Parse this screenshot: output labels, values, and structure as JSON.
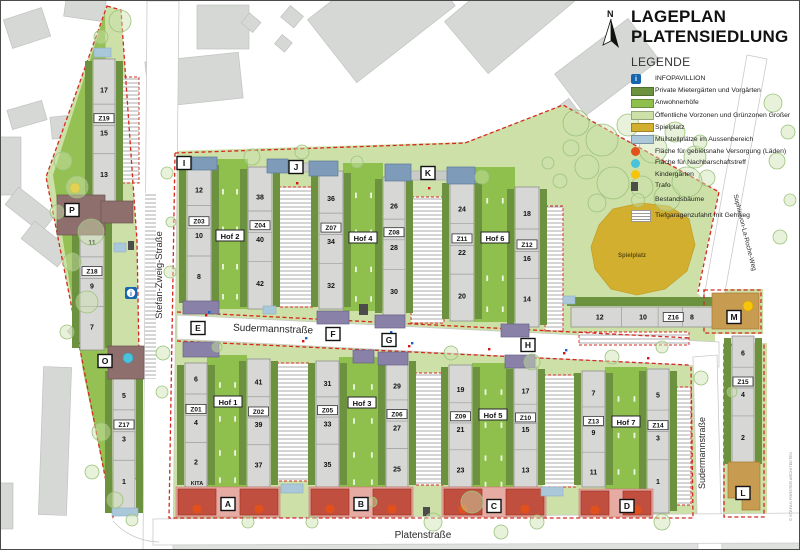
{
  "title": {
    "line1": "LAGEPLAN",
    "line2": "PLATENSIEDLUNG"
  },
  "legend": {
    "heading": "LEGENDE",
    "items": [
      {
        "label": "INFOPAVILLION",
        "type": "info",
        "color": "#1467af"
      },
      {
        "label": "Private Mietergärten und Vorgärten",
        "type": "rect",
        "color": "#6d923f"
      },
      {
        "label": "Anwohnerhöfe",
        "type": "rect",
        "color": "#8fc04d"
      },
      {
        "label": "Öffentliche Vorzonen und Grünzonen Großer",
        "type": "rect",
        "color": "#cde0a8"
      },
      {
        "label": "Spielplatz",
        "type": "rect",
        "color": "#d2af2e"
      },
      {
        "label": "Müllstellplätze im Aussenbereich",
        "type": "rect",
        "color": "#abc7da"
      },
      {
        "label": "Fläche für gebietsnahe Versorgung (Läden)",
        "type": "circle",
        "color": "#e2511b"
      },
      {
        "label": "Fläche für Nachbarschaftstreff",
        "type": "circle",
        "color": "#49c2dc"
      },
      {
        "label": "Kindergärten",
        "type": "circle",
        "color": "#f6c40a"
      },
      {
        "label": "Trafo",
        "type": "small",
        "color": "#4c4c4a"
      },
      {
        "label": "Bestandsbäume",
        "type": "tree",
        "color": "#a8c888"
      },
      {
        "label": "Tiefgaragenzufahrt mit Gehweg",
        "type": "hatch",
        "color": "#9a9a98"
      }
    ]
  },
  "map": {
    "north_label": "N",
    "credit": "© STEFAN FORSTER ARCHITEKTEN",
    "street_labels": [
      {
        "name": "Stefan-Zweig-Straße",
        "x": 161,
        "y": 274,
        "rotate": -90,
        "size": 9.5
      },
      {
        "name": "Sudermannstraße",
        "x": 272,
        "y": 331,
        "rotate": 2,
        "size": 10
      },
      {
        "name": "Sudermannstraße",
        "x": 704,
        "y": 452,
        "rotate": -90,
        "size": 9
      },
      {
        "name": "Platenstraße",
        "x": 422,
        "y": 537,
        "rotate": 0,
        "size": 10
      },
      {
        "name": "Sophie-von-La-Roche-Weg",
        "x": 742,
        "y": 232,
        "rotate": 76,
        "size": 6.5
      }
    ],
    "area_labels": [
      {
        "name": "Spielplatz",
        "x": 631,
        "y": 256,
        "size": 6,
        "color": "#5f4d10"
      },
      {
        "name": "KITA",
        "x": 196,
        "y": 484,
        "size": 5.5,
        "color": "#1a1a1a"
      }
    ],
    "hof_labels": [
      {
        "label": "Hof 1",
        "x": 227,
        "y": 401
      },
      {
        "label": "Hof 2",
        "x": 229,
        "y": 235
      },
      {
        "label": "Hof 3",
        "x": 361,
        "y": 402
      },
      {
        "label": "Hof 4",
        "x": 362,
        "y": 237
      },
      {
        "label": "Hof 5",
        "x": 492,
        "y": 414
      },
      {
        "label": "Hof 6",
        "x": 494,
        "y": 237
      },
      {
        "label": "Hof 7",
        "x": 625,
        "y": 421
      }
    ],
    "markers": [
      {
        "id": "A",
        "x": 227,
        "y": 503
      },
      {
        "id": "B",
        "x": 360,
        "y": 503
      },
      {
        "id": "C",
        "x": 493,
        "y": 505
      },
      {
        "id": "D",
        "x": 626,
        "y": 505
      },
      {
        "id": "E",
        "x": 197,
        "y": 327
      },
      {
        "id": "F",
        "x": 332,
        "y": 333
      },
      {
        "id": "G",
        "x": 388,
        "y": 339
      },
      {
        "id": "H",
        "x": 527,
        "y": 344
      },
      {
        "id": "I",
        "x": 183,
        "y": 162
      },
      {
        "id": "J",
        "x": 295,
        "y": 166
      },
      {
        "id": "K",
        "x": 427,
        "y": 172
      },
      {
        "id": "L",
        "x": 742,
        "y": 492
      },
      {
        "id": "M",
        "x": 733,
        "y": 316
      },
      {
        "id": "O",
        "x": 104,
        "y": 360
      },
      {
        "id": "P",
        "x": 71,
        "y": 209
      }
    ],
    "buildings": [
      {
        "z": "Z19",
        "orient": "v",
        "x": 92,
        "y": 58,
        "w": 22,
        "h": 148,
        "segs": [
          {
            "label": "17",
            "f": 0.21
          },
          {
            "label": "Z19",
            "f": 0.4,
            "box": true
          },
          {
            "label": "15",
            "f": 0.5
          },
          {
            "label": "13",
            "f": 0.78
          }
        ]
      },
      {
        "z": "Z18",
        "orient": "v",
        "x": 79,
        "y": 213,
        "w": 24,
        "h": 136,
        "segs": [
          {
            "label": "11",
            "f": 0.21
          },
          {
            "label": "Z18",
            "f": 0.42,
            "box": true
          },
          {
            "label": "9",
            "f": 0.53
          },
          {
            "label": "7",
            "f": 0.83
          }
        ]
      },
      {
        "z": "Z17",
        "orient": "v",
        "x": 112,
        "y": 368,
        "w": 22,
        "h": 146,
        "segs": [
          {
            "label": "5",
            "f": 0.18
          },
          {
            "label": "Z17",
            "f": 0.38,
            "box": true
          },
          {
            "label": "3",
            "f": 0.48
          },
          {
            "label": "1",
            "f": 0.77
          }
        ]
      },
      {
        "z": "Z03",
        "orient": "v",
        "x": 186,
        "y": 162,
        "w": 24,
        "h": 142,
        "segs": [
          {
            "label": "12",
            "f": 0.19
          },
          {
            "label": "Z03",
            "f": 0.41,
            "box": true
          },
          {
            "label": "10",
            "f": 0.51
          },
          {
            "label": "8",
            "f": 0.8
          }
        ]
      },
      {
        "z": "Z04",
        "orient": "v",
        "x": 247,
        "y": 166,
        "w": 24,
        "h": 142,
        "segs": [
          {
            "label": "38",
            "f": 0.21
          },
          {
            "label": "Z04",
            "f": 0.41,
            "box": true
          },
          {
            "label": "40",
            "f": 0.51
          },
          {
            "label": "42",
            "f": 0.82
          }
        ]
      },
      {
        "z": "Z07",
        "orient": "v",
        "x": 318,
        "y": 170,
        "w": 24,
        "h": 138,
        "segs": [
          {
            "label": "36",
            "f": 0.2
          },
          {
            "label": "Z07",
            "f": 0.41,
            "box": true
          },
          {
            "label": "34",
            "f": 0.51
          },
          {
            "label": "32",
            "f": 0.83
          }
        ]
      },
      {
        "z": "Z08",
        "orient": "v",
        "x": 382,
        "y": 176,
        "w": 22,
        "h": 138,
        "segs": [
          {
            "label": "26",
            "f": 0.21
          },
          {
            "label": "Z08",
            "f": 0.4,
            "box": true
          },
          {
            "label": "28",
            "f": 0.51
          },
          {
            "label": "30",
            "f": 0.83
          }
        ]
      },
      {
        "z": "Z11",
        "orient": "v",
        "x": 449,
        "y": 180,
        "w": 24,
        "h": 140,
        "segs": [
          {
            "label": "24",
            "f": 0.2
          },
          {
            "label": "Z11",
            "f": 0.41,
            "box": true
          },
          {
            "label": "22",
            "f": 0.51
          },
          {
            "label": "20",
            "f": 0.82
          }
        ]
      },
      {
        "z": "Z12",
        "orient": "v",
        "x": 514,
        "y": 186,
        "w": 24,
        "h": 140,
        "segs": [
          {
            "label": "18",
            "f": 0.19
          },
          {
            "label": "Z12",
            "f": 0.41,
            "box": true
          },
          {
            "label": "16",
            "f": 0.51
          },
          {
            "label": "14",
            "f": 0.8
          }
        ]
      },
      {
        "z": "Z01",
        "orient": "v",
        "x": 184,
        "y": 362,
        "w": 22,
        "h": 124,
        "segs": [
          {
            "label": "6",
            "f": 0.13
          },
          {
            "label": "Z01",
            "f": 0.37,
            "box": true
          },
          {
            "label": "4",
            "f": 0.48
          },
          {
            "label": "2",
            "f": 0.8
          }
        ]
      },
      {
        "z": "Z02",
        "orient": "v",
        "x": 246,
        "y": 358,
        "w": 23,
        "h": 128,
        "segs": [
          {
            "label": "41",
            "f": 0.18
          },
          {
            "label": "Z02",
            "f": 0.41,
            "box": true
          },
          {
            "label": "39",
            "f": 0.51
          },
          {
            "label": "37",
            "f": 0.83
          }
        ]
      },
      {
        "z": "Z05",
        "orient": "v",
        "x": 315,
        "y": 360,
        "w": 23,
        "h": 126,
        "segs": [
          {
            "label": "31",
            "f": 0.18
          },
          {
            "label": "Z05",
            "f": 0.39,
            "box": true
          },
          {
            "label": "33",
            "f": 0.5
          },
          {
            "label": "35",
            "f": 0.82
          }
        ]
      },
      {
        "z": "Z06",
        "orient": "v",
        "x": 385,
        "y": 358,
        "w": 22,
        "h": 128,
        "segs": [
          {
            "label": "29",
            "f": 0.21
          },
          {
            "label": "Z06",
            "f": 0.43,
            "box": true
          },
          {
            "label": "27",
            "f": 0.54
          },
          {
            "label": "25",
            "f": 0.86
          }
        ]
      },
      {
        "z": "Z09",
        "orient": "v",
        "x": 448,
        "y": 364,
        "w": 23,
        "h": 122,
        "segs": [
          {
            "label": "19",
            "f": 0.2
          },
          {
            "label": "Z09",
            "f": 0.42,
            "box": true
          },
          {
            "label": "21",
            "f": 0.53
          },
          {
            "label": "23",
            "f": 0.86
          }
        ]
      },
      {
        "z": "Z10",
        "orient": "v",
        "x": 513,
        "y": 366,
        "w": 23,
        "h": 120,
        "segs": [
          {
            "label": "17",
            "f": 0.2
          },
          {
            "label": "Z10",
            "f": 0.42,
            "box": true
          },
          {
            "label": "15",
            "f": 0.52
          },
          {
            "label": "13",
            "f": 0.86
          }
        ]
      },
      {
        "z": "Z13",
        "orient": "v",
        "x": 581,
        "y": 370,
        "w": 23,
        "h": 116,
        "segs": [
          {
            "label": "7",
            "f": 0.19
          },
          {
            "label": "Z13",
            "f": 0.43,
            "box": true
          },
          {
            "label": "9",
            "f": 0.53
          },
          {
            "label": "11",
            "f": 0.87
          }
        ]
      },
      {
        "z": "Z14",
        "orient": "v",
        "x": 646,
        "y": 368,
        "w": 22,
        "h": 144,
        "segs": [
          {
            "label": "5",
            "f": 0.18
          },
          {
            "label": "Z14",
            "f": 0.39,
            "box": true
          },
          {
            "label": "3",
            "f": 0.48
          },
          {
            "label": "1",
            "f": 0.78
          }
        ]
      },
      {
        "z": "Z15",
        "orient": "v",
        "x": 731,
        "y": 335,
        "w": 22,
        "h": 130,
        "segs": [
          {
            "label": "6",
            "f": 0.13
          },
          {
            "label": "Z15",
            "f": 0.35,
            "box": true
          },
          {
            "label": "4",
            "f": 0.45
          },
          {
            "label": "2",
            "f": 0.78
          }
        ]
      },
      {
        "z": "Z16",
        "orient": "h",
        "x": 570,
        "y": 306,
        "w": 144,
        "h": 20,
        "segs": [
          {
            "label": "12",
            "f": 0.2
          },
          {
            "label": "10",
            "f": 0.5
          },
          {
            "label": "Z16",
            "f": 0.71,
            "box": true
          },
          {
            "label": "8",
            "f": 0.84
          }
        ]
      }
    ]
  }
}
